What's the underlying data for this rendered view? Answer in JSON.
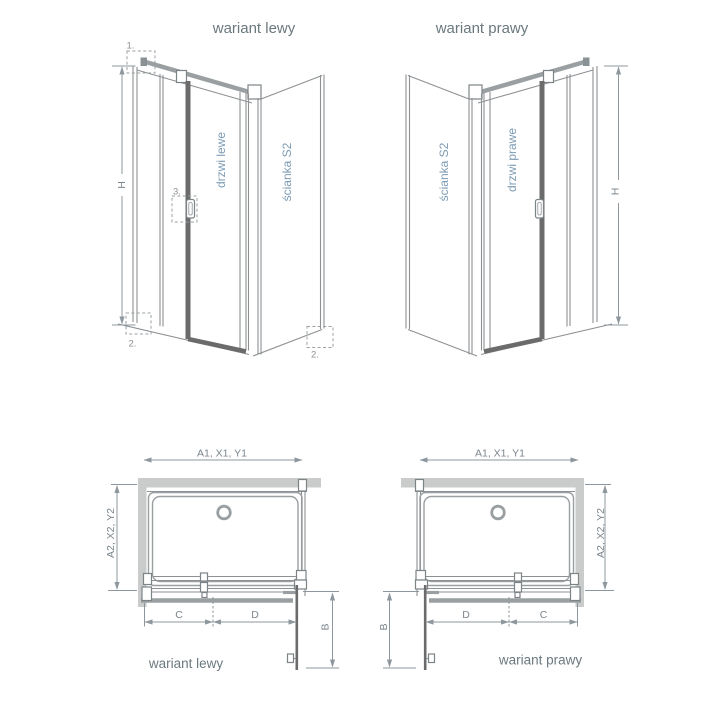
{
  "top_left_view": {
    "title": "wariant lewy",
    "height_dim": "H",
    "door_label": "drzwi lewe",
    "wall_label": "ścianka S2",
    "callout_top_profile": "1.",
    "callout_bottom_profile": "2.",
    "callout_handle": "3."
  },
  "top_right_view": {
    "title": "wariant prawy",
    "height_dim": "H",
    "door_label": "drzwi prawe",
    "wall_label": "ścianka S2"
  },
  "bottom_left_view": {
    "caption": "wariant lewy",
    "width_dim": "A1, X1, Y1",
    "depth_dim": "A2, X2, Y2",
    "fixed_segment": "C",
    "door_segment": "D",
    "door_extension": "B"
  },
  "bottom_right_view": {
    "caption": "wariant prawy",
    "width_dim": "A1, X1, Y1",
    "depth_dim": "A2, X2, Y2",
    "fixed_segment": "C",
    "door_segment": "D",
    "door_extension": "B"
  },
  "colors": {
    "background": "#ffffff",
    "line_gray": "#8d9194",
    "profile_gray": "#9aa0a2",
    "dark_profile": "#6b6b6b",
    "wall_fill": "#cacbcb",
    "dimension": "#8d979d",
    "dimension_text": "#7b868d",
    "label_blue": "#7d9bb4",
    "title_text": "#6b797f"
  }
}
